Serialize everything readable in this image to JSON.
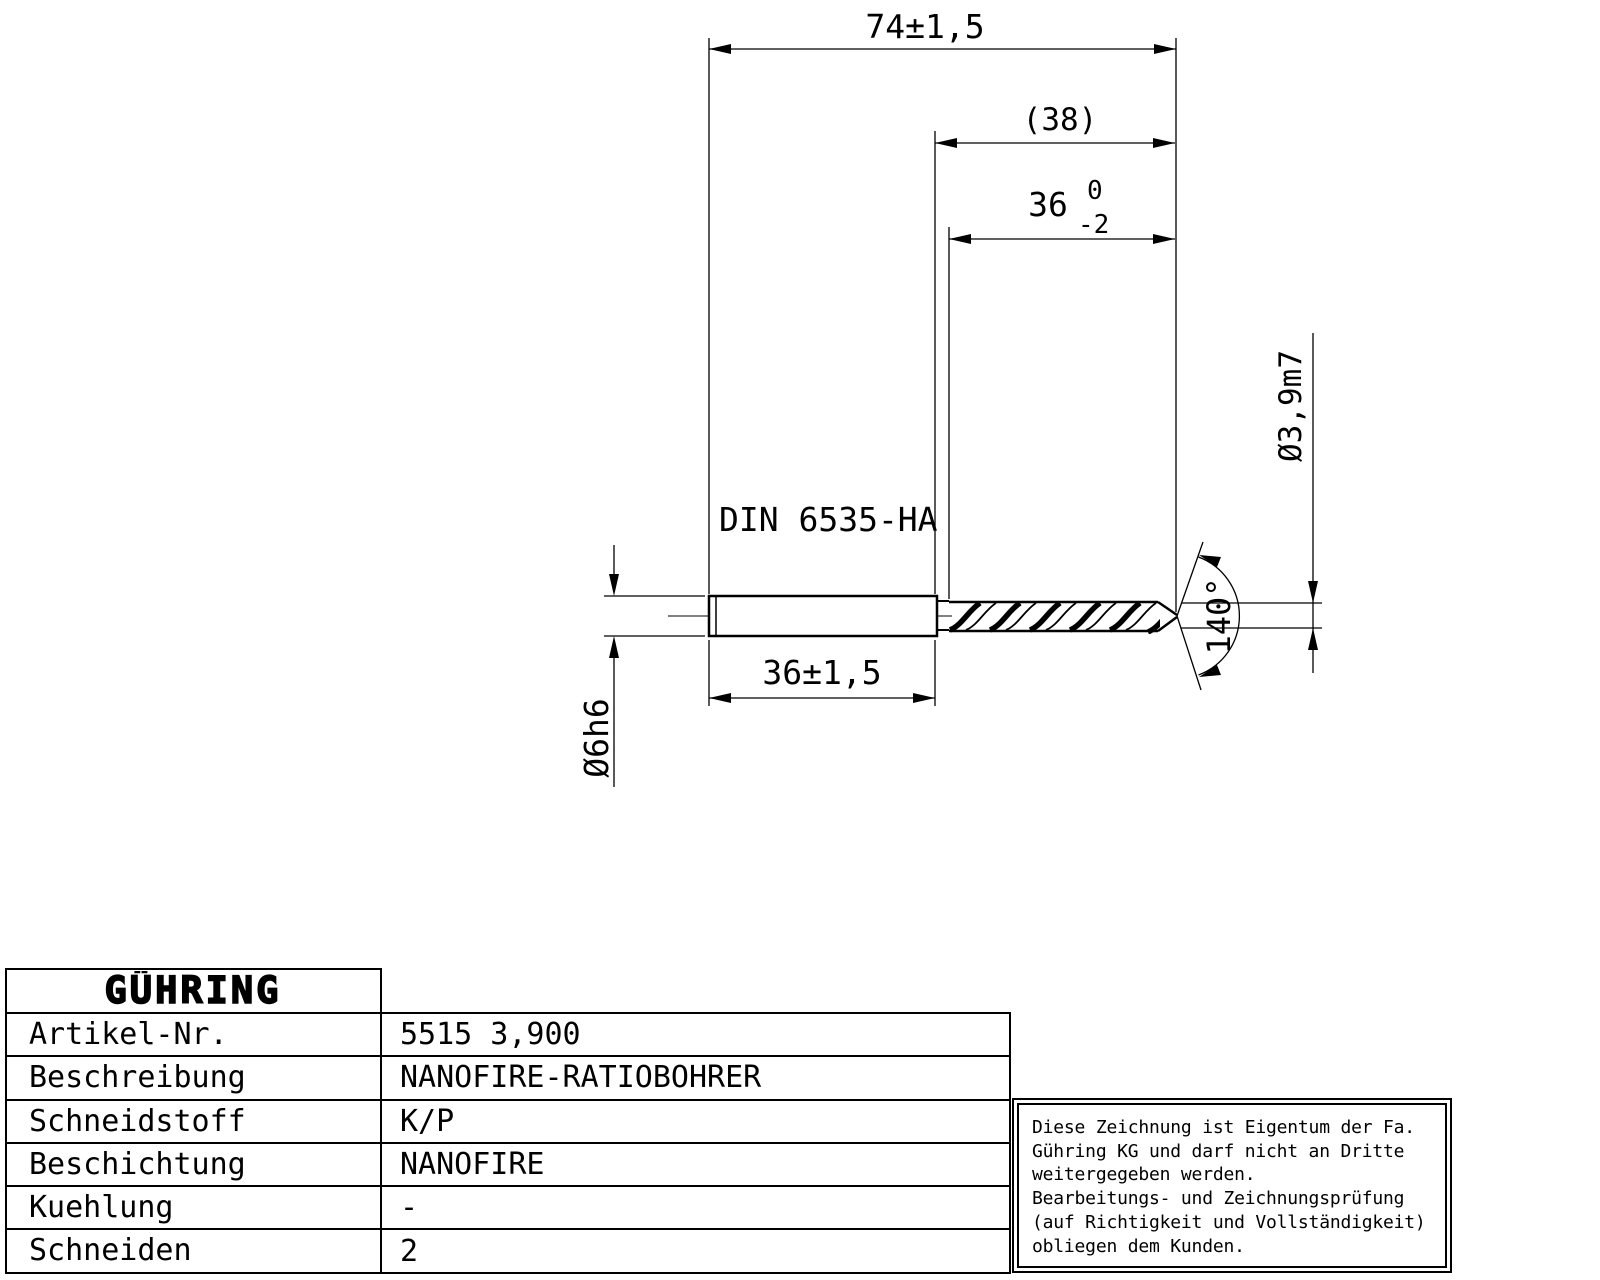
{
  "drawing": {
    "dim_total_length": "74±1,5",
    "dim_flute_length_ref": "(38)",
    "dim_flute_length": {
      "value": "36",
      "upper_tol": "0",
      "lower_tol": "-2"
    },
    "dim_shank_length": "36±1,5",
    "dim_shank_diameter": "Ø6h6",
    "dim_drill_diameter": "Ø3,9m7",
    "dim_point_angle": "140°",
    "shank_standard": "DIN 6535-HA"
  },
  "title_block": {
    "logo": "GÜHRING",
    "rows": [
      {
        "label": "Artikel-Nr.",
        "value": "5515 3,900"
      },
      {
        "label": "Beschreibung",
        "value": "NANOFIRE-RATIOBOHRER"
      },
      {
        "label": "Schneidstoff",
        "value": "K/P"
      },
      {
        "label": "Beschichtung",
        "value": "NANOFIRE"
      },
      {
        "label": "Kuehlung",
        "value": "-"
      },
      {
        "label": "Schneiden",
        "value": "2"
      }
    ]
  },
  "note": {
    "lines": [
      "Diese Zeichnung ist Eigentum der Fa.",
      "Gühring KG und darf nicht an Dritte",
      "weitergegeben werden.",
      "Bearbeitungs- und Zeichnungsprüfung",
      "(auf Richtigkeit und Vollständigkeit)",
      "obliegen dem Kunden."
    ]
  },
  "colors": {
    "line": "#000000",
    "background": "#ffffff"
  }
}
